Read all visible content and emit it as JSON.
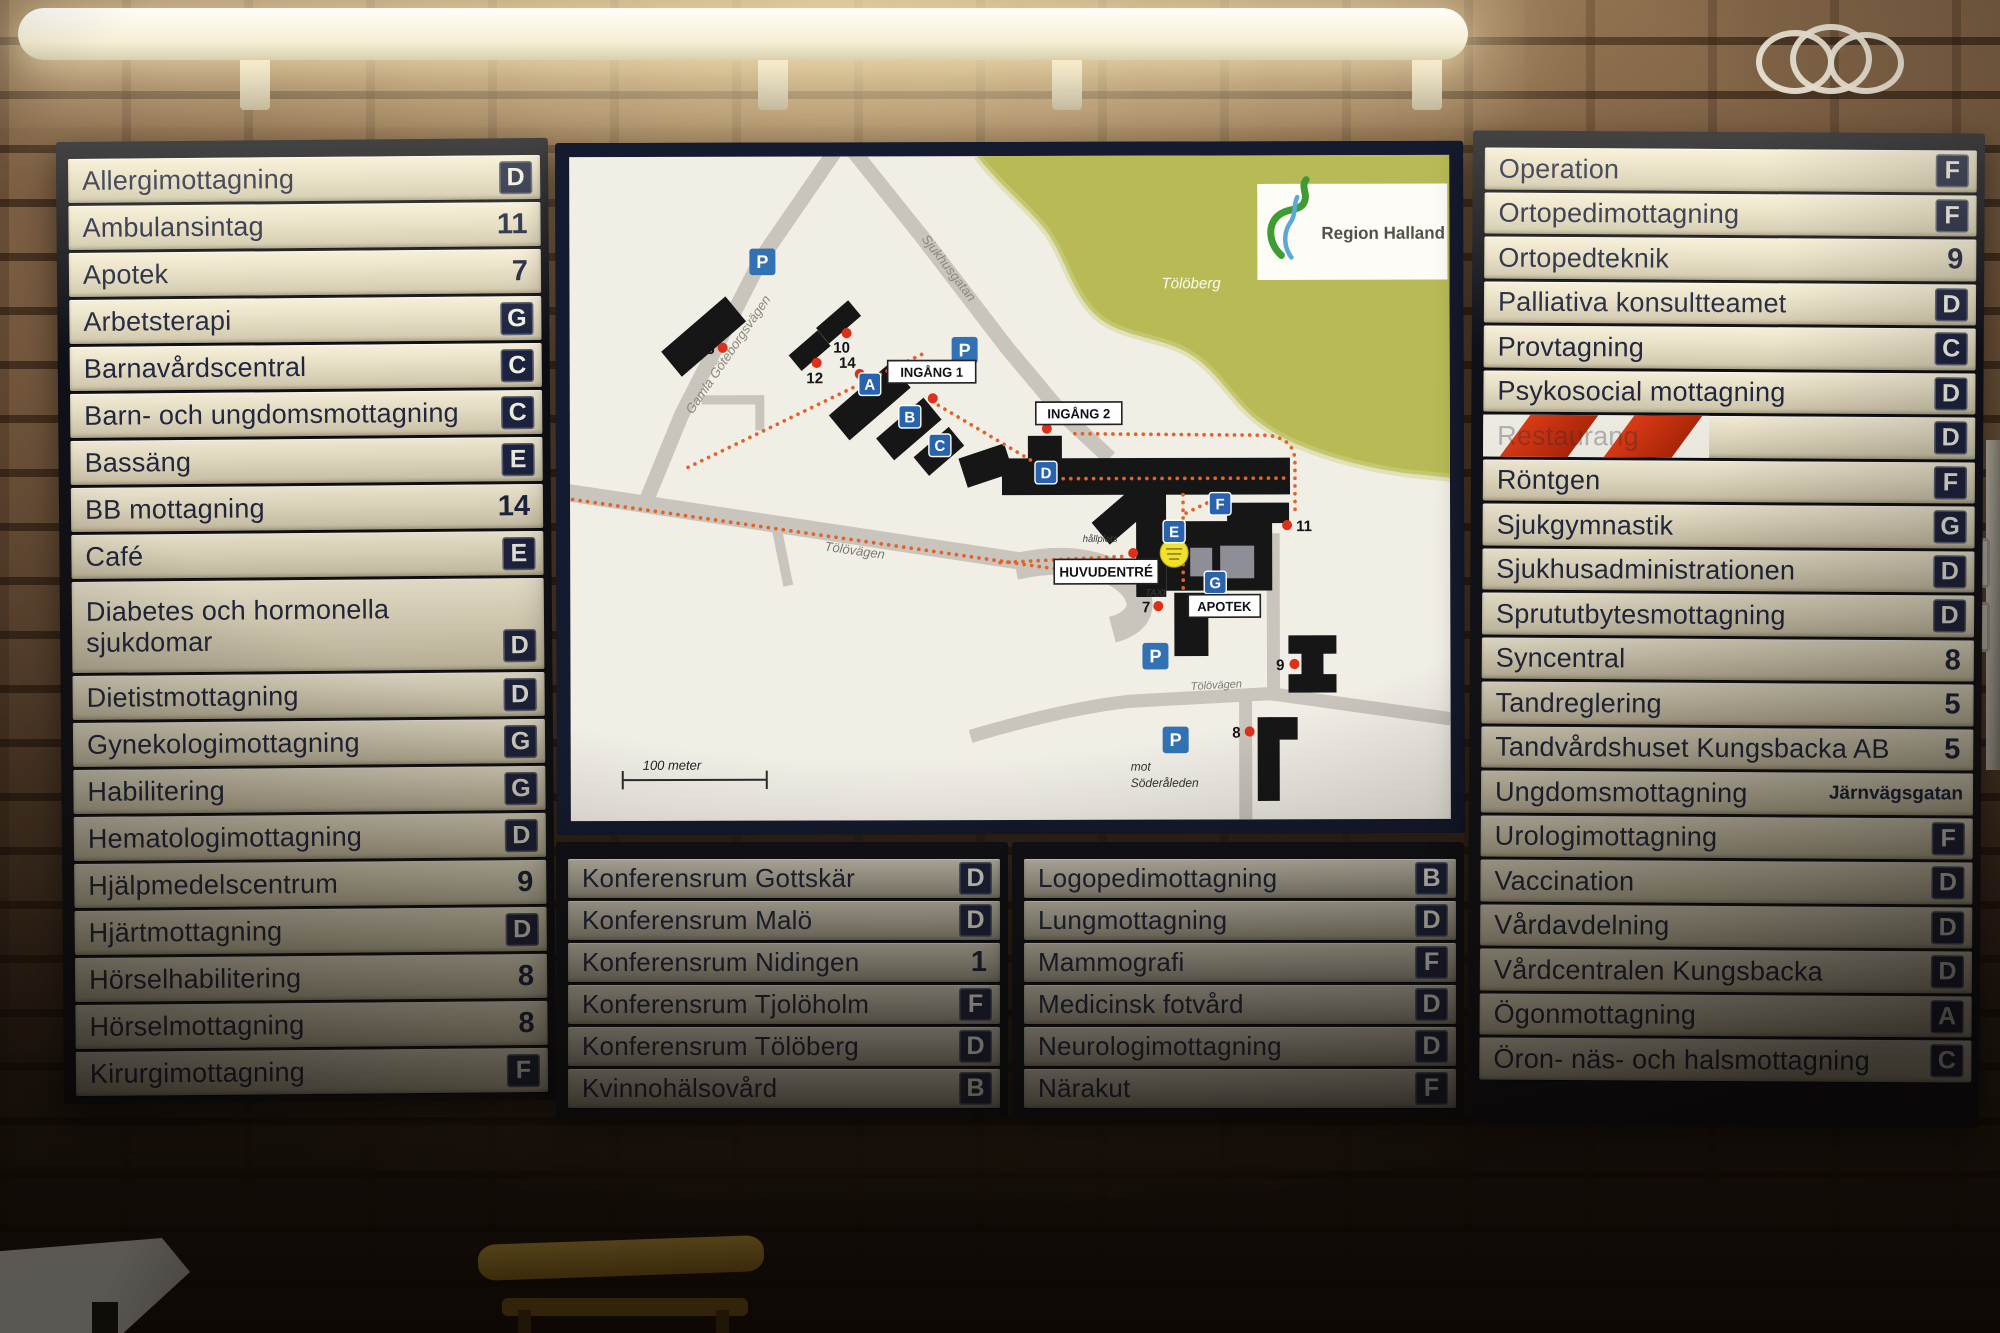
{
  "board": {
    "left_panel": {
      "rows": [
        {
          "label": "Allergimottagning",
          "code": "D",
          "code_type": "letter"
        },
        {
          "label": "Ambulansintag",
          "code": "11",
          "code_type": "number"
        },
        {
          "label": "Apotek",
          "code": "7",
          "code_type": "number"
        },
        {
          "label": "Arbetsterapi",
          "code": "G",
          "code_type": "letter"
        },
        {
          "label": "Barnavårdscentral",
          "code": "C",
          "code_type": "letter"
        },
        {
          "label": "Barn- och ungdomsmottagning",
          "code": "C",
          "code_type": "letter"
        },
        {
          "label": "Bassäng",
          "code": "E",
          "code_type": "letter"
        },
        {
          "label": "BB mottagning",
          "code": "14",
          "code_type": "number"
        },
        {
          "label": "Café",
          "code": "E",
          "code_type": "letter"
        },
        {
          "label": "Diabetes och hormonella\nsjukdomar",
          "code": "D",
          "code_type": "letter",
          "double": true
        },
        {
          "label": "Dietistmottagning",
          "code": "D",
          "code_type": "letter"
        },
        {
          "label": "Gynekologimottagning",
          "code": "G",
          "code_type": "letter"
        },
        {
          "label": "Habilitering",
          "code": "G",
          "code_type": "letter"
        },
        {
          "label": "Hematologimottagning",
          "code": "D",
          "code_type": "letter"
        },
        {
          "label": "Hjälpmedelscentrum",
          "code": "9",
          "code_type": "number"
        },
        {
          "label": "Hjärtmottagning",
          "code": "D",
          "code_type": "letter"
        },
        {
          "label": "Hörselhabilitering",
          "code": "8",
          "code_type": "number"
        },
        {
          "label": "Hörselmottagning",
          "code": "8",
          "code_type": "number"
        },
        {
          "label": "Kirurgimottagning",
          "code": "F",
          "code_type": "letter"
        }
      ]
    },
    "bottom_left_panel": {
      "rows": [
        {
          "label": "Konferensrum Gottskär",
          "code": "D",
          "code_type": "letter"
        },
        {
          "label": "Konferensrum Malö",
          "code": "D",
          "code_type": "letter"
        },
        {
          "label": "Konferensrum Nidingen",
          "code": "1",
          "code_type": "number"
        },
        {
          "label": "Konferensrum Tjolöholm",
          "code": "F",
          "code_type": "letter"
        },
        {
          "label": "Konferensrum Tölöberg",
          "code": "D",
          "code_type": "letter"
        },
        {
          "label": "Kvinnohälsovård",
          "code": "B",
          "code_type": "letter"
        }
      ]
    },
    "bottom_right_panel": {
      "rows": [
        {
          "label": "Logopedimottagning",
          "code": "B",
          "code_type": "letter"
        },
        {
          "label": "Lungmottagning",
          "code": "D",
          "code_type": "letter"
        },
        {
          "label": "Mammografi",
          "code": "F",
          "code_type": "letter"
        },
        {
          "label": "Medicinsk fotvård",
          "code": "D",
          "code_type": "letter"
        },
        {
          "label": "Neurologimottagning",
          "code": "D",
          "code_type": "letter"
        },
        {
          "label": "Närakut",
          "code": "F",
          "code_type": "letter"
        }
      ]
    },
    "right_panel": {
      "rows": [
        {
          "label": "Operation",
          "code": "F",
          "code_type": "letter"
        },
        {
          "label": "Ortopedimottagning",
          "code": "F",
          "code_type": "letter"
        },
        {
          "label": "Ortopedteknik",
          "code": "9",
          "code_type": "number"
        },
        {
          "label": "Palliativa konsultteamet",
          "code": "D",
          "code_type": "letter"
        },
        {
          "label": "Provtagning",
          "code": "C",
          "code_type": "letter"
        },
        {
          "label": "Psykosocial mottagning",
          "code": "D",
          "code_type": "letter"
        },
        {
          "label": "Restaurang",
          "code": "D",
          "code_type": "letter",
          "closed": true
        },
        {
          "label": "Röntgen",
          "code": "F",
          "code_type": "letter"
        },
        {
          "label": "Sjukgymnastik",
          "code": "G",
          "code_type": "letter"
        },
        {
          "label": "Sjukhusadministrationen",
          "code": "D",
          "code_type": "letter"
        },
        {
          "label": "Sprututbytesmottagning",
          "code": "D",
          "code_type": "letter"
        },
        {
          "label": "Syncentral",
          "code": "8",
          "code_type": "number"
        },
        {
          "label": "Tandreglering",
          "code": "5",
          "code_type": "number"
        },
        {
          "label": "Tandvårdshuset Kungsbacka AB",
          "code": "5",
          "code_type": "number"
        },
        {
          "label": "Ungdomsmottagning",
          "code": "Järnvägsgatan",
          "code_type": "text"
        },
        {
          "label": "Urologimottagning",
          "code": "F",
          "code_type": "letter"
        },
        {
          "label": "Vaccination",
          "code": "D",
          "code_type": "letter"
        },
        {
          "label": "Vårdavdelning",
          "code": "D",
          "code_type": "letter"
        },
        {
          "label": "Vårdcentralen Kungsbacka",
          "code": "D",
          "code_type": "letter"
        },
        {
          "label": "Ögonmottagning",
          "code": "A",
          "code_type": "letter"
        },
        {
          "label": "Öron- näs- och halsmottagning",
          "code": "C",
          "code_type": "letter"
        }
      ]
    },
    "map": {
      "logo": "Region Halland",
      "labels": {
        "parking": "P",
        "toloberg": "Tölöberg",
        "ingang1": "INGÅNG 1",
        "ingang2": "INGÅNG 2",
        "huvudentre": "HUVUDENTRÉ",
        "apotek": "APOTEK",
        "hallplats": "hållplats",
        "taxi": "TAXI",
        "scale": "100 meter",
        "mot": "mot",
        "soderaleden": "Söderåleden",
        "tolovagen": "Tölövägen",
        "gamla_goteborgsvagen": "Gamla Göteborgsvägen",
        "sjukhusgatan": "Sjukhusgatan"
      },
      "entrances": [
        "A",
        "B",
        "C",
        "D",
        "E",
        "F",
        "G"
      ],
      "sites": [
        "5",
        "10",
        "12",
        "14",
        "7",
        "11",
        "9",
        "8"
      ],
      "colors": {
        "badge_navy": "#1c2340",
        "closed_stripe_red": "#d8361a",
        "parking_blue": "#3272b4",
        "entrance_blue": "#2a63ad",
        "map_green": "#b8ba55",
        "route_orange": "#e2622a",
        "building_black": "#161616",
        "marker_red": "#dd3018",
        "you_are_here_yellow": "#f0e22c"
      }
    }
  }
}
